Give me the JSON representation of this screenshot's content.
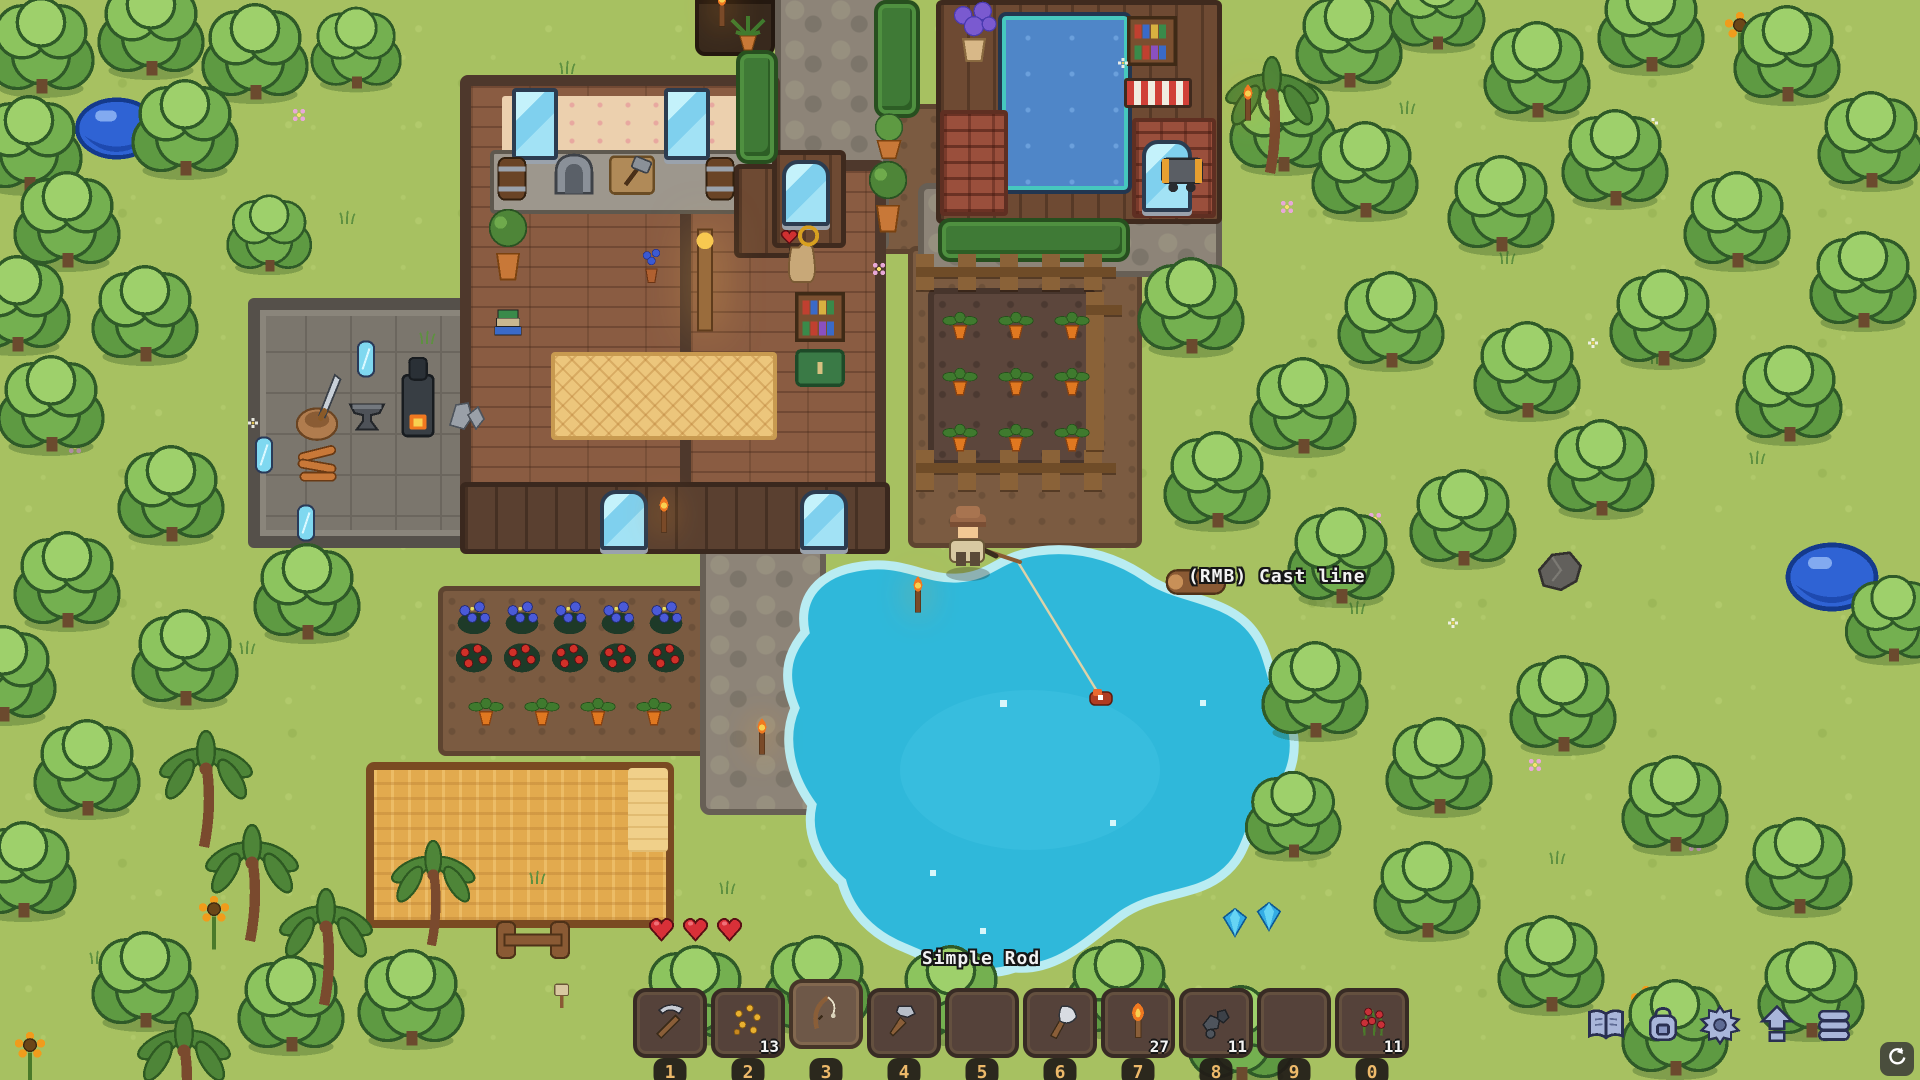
{
  "hud": {
    "selected_item_label": "Simple Rod",
    "action_hint": "(RMB) Cast line",
    "hotbar": {
      "slots": [
        {
          "key": "1",
          "icon": "pickaxe-icon",
          "count": null,
          "selected": false
        },
        {
          "key": "2",
          "icon": "seeds-icon",
          "count": "13",
          "selected": false
        },
        {
          "key": "3",
          "icon": "fishing-rod-icon",
          "count": null,
          "selected": true
        },
        {
          "key": "4",
          "icon": "hammer-icon",
          "count": null,
          "selected": false
        },
        {
          "key": "5",
          "icon": null,
          "count": null,
          "selected": false
        },
        {
          "key": "6",
          "icon": "axe-icon",
          "count": null,
          "selected": false
        },
        {
          "key": "7",
          "icon": "torch-icon",
          "count": "27",
          "selected": false
        },
        {
          "key": "8",
          "icon": "ore-icon",
          "count": "11",
          "selected": false
        },
        {
          "key": "9",
          "icon": null,
          "count": null,
          "selected": false
        },
        {
          "key": "0",
          "icon": "berries-icon",
          "count": "11",
          "selected": false
        }
      ]
    },
    "menu_buttons": [
      {
        "name": "journal-button",
        "icon": "book-icon"
      },
      {
        "name": "inventory-button",
        "icon": "backpack-icon"
      },
      {
        "name": "settings-button",
        "icon": "gear-icon"
      },
      {
        "name": "upgrades-button",
        "icon": "up-arrows-icon"
      },
      {
        "name": "storage-button",
        "icon": "barrel-icon"
      }
    ],
    "autosave_indicator": {
      "icon": "sync-icon"
    }
  },
  "colors": {
    "grass": "#a7c161",
    "water": "#2fb8da",
    "foam": "#b9ecf2",
    "hotbar_slot": "#55423a",
    "badge_text": "#edb96a",
    "menu_icon": "#a9b6da",
    "menu_icon_outline": "#2a3052",
    "heart": "#d83038",
    "gem": "#34ace4"
  },
  "scene": {
    "sprites": [
      {
        "t": "tree",
        "x": -18,
        "y": -6
      },
      {
        "t": "tree",
        "x": 92,
        "y": -24
      },
      {
        "t": "tree",
        "x": 196,
        "y": 0
      },
      {
        "t": "tree",
        "x": 306,
        "y": 4,
        "s": 0.85
      },
      {
        "t": "tree",
        "x": -30,
        "y": 92
      },
      {
        "t": "tree",
        "x": 126,
        "y": 76
      },
      {
        "t": "tree",
        "x": 8,
        "y": 168
      },
      {
        "t": "tree",
        "x": -42,
        "y": 252
      },
      {
        "t": "tree",
        "x": 86,
        "y": 262
      },
      {
        "t": "tree",
        "x": 222,
        "y": 192,
        "s": 0.8
      },
      {
        "t": "tree",
        "x": -8,
        "y": 352
      },
      {
        "t": "tree",
        "x": 112,
        "y": 442
      },
      {
        "t": "tree",
        "x": 8,
        "y": 528
      },
      {
        "t": "tree",
        "x": -56,
        "y": 622
      },
      {
        "t": "tree",
        "x": 126,
        "y": 606
      },
      {
        "t": "tree",
        "x": 248,
        "y": 540
      },
      {
        "t": "tree",
        "x": 28,
        "y": 716
      },
      {
        "t": "tree",
        "x": -36,
        "y": 818
      },
      {
        "t": "tree",
        "x": 86,
        "y": 928
      },
      {
        "t": "tree",
        "x": 232,
        "y": 952
      },
      {
        "t": "tree",
        "x": 352,
        "y": 946
      },
      {
        "t": "tree",
        "x": 636,
        "y": 942
      },
      {
        "t": "tree",
        "x": 758,
        "y": 932
      },
      {
        "t": "tree",
        "x": 892,
        "y": 942
      },
      {
        "t": "tree",
        "x": 1060,
        "y": 936
      },
      {
        "t": "tree",
        "x": 1182,
        "y": 982
      },
      {
        "t": "tree",
        "x": 1224,
        "y": 72
      },
      {
        "t": "tree",
        "x": 1290,
        "y": -12
      },
      {
        "t": "tree",
        "x": 1384,
        "y": -40,
        "s": 0.9
      },
      {
        "t": "tree",
        "x": 1478,
        "y": 18
      },
      {
        "t": "tree",
        "x": 1592,
        "y": -28
      },
      {
        "t": "tree",
        "x": 1728,
        "y": 2
      },
      {
        "t": "tree",
        "x": 1812,
        "y": 88
      },
      {
        "t": "tree",
        "x": 1306,
        "y": 118
      },
      {
        "t": "tree",
        "x": 1442,
        "y": 152
      },
      {
        "t": "tree",
        "x": 1556,
        "y": 106
      },
      {
        "t": "tree",
        "x": 1678,
        "y": 168
      },
      {
        "t": "tree",
        "x": 1804,
        "y": 228
      },
      {
        "t": "tree",
        "x": 1332,
        "y": 268
      },
      {
        "t": "tree",
        "x": 1468,
        "y": 318
      },
      {
        "t": "tree",
        "x": 1604,
        "y": 266
      },
      {
        "t": "tree",
        "x": 1730,
        "y": 342
      },
      {
        "t": "tree",
        "x": 1132,
        "y": 254
      },
      {
        "t": "tree",
        "x": 1244,
        "y": 354
      },
      {
        "t": "tree",
        "x": 1158,
        "y": 428
      },
      {
        "t": "tree",
        "x": 1282,
        "y": 504
      },
      {
        "t": "tree",
        "x": 1404,
        "y": 466
      },
      {
        "t": "tree",
        "x": 1542,
        "y": 416
      },
      {
        "t": "tree",
        "x": 1256,
        "y": 638
      },
      {
        "t": "tree",
        "x": 1380,
        "y": 714
      },
      {
        "t": "tree",
        "x": 1504,
        "y": 652
      },
      {
        "t": "tree",
        "x": 1368,
        "y": 838
      },
      {
        "t": "tree",
        "x": 1240,
        "y": 768,
        "s": 0.9
      },
      {
        "t": "tree",
        "x": 1616,
        "y": 752
      },
      {
        "t": "tree",
        "x": 1740,
        "y": 814
      },
      {
        "t": "tree",
        "x": 1492,
        "y": 912
      },
      {
        "t": "tree",
        "x": 1616,
        "y": 976
      },
      {
        "t": "tree",
        "x": 1752,
        "y": 938
      },
      {
        "t": "tree",
        "x": 1840,
        "y": 572,
        "s": 0.9
      },
      {
        "t": "palm",
        "x": 158,
        "y": 730
      },
      {
        "t": "palm",
        "x": 204,
        "y": 824
      },
      {
        "t": "palm",
        "x": 278,
        "y": 888
      },
      {
        "t": "palm",
        "x": 136,
        "y": 1012
      },
      {
        "t": "palm",
        "x": 390,
        "y": 840,
        "s": 0.9
      },
      {
        "t": "palm",
        "x": 1224,
        "y": 56
      },
      {
        "t": "slime",
        "x": 70,
        "y": 88,
        "s": 0.9
      },
      {
        "t": "slime",
        "x": 1780,
        "y": 532
      },
      {
        "t": "heart",
        "x": 646,
        "y": 914
      },
      {
        "t": "heart",
        "x": 680,
        "y": 914
      },
      {
        "t": "heart",
        "x": 714,
        "y": 914
      },
      {
        "t": "gem",
        "x": 1220,
        "y": 904
      },
      {
        "t": "gem",
        "x": 1254,
        "y": 898
      },
      {
        "t": "sunflower",
        "x": 1718,
        "y": 2
      },
      {
        "t": "sunflower",
        "x": 1624,
        "y": 976
      },
      {
        "t": "sunflower",
        "x": 192,
        "y": 886
      },
      {
        "t": "sunflower",
        "x": 8,
        "y": 1022
      },
      {
        "t": "rockbig",
        "x": 1534,
        "y": 544
      },
      {
        "t": "log",
        "x": 1158,
        "y": 566
      },
      {
        "t": "fencebit",
        "x": 490,
        "y": 918
      },
      {
        "t": "sign",
        "x": 546,
        "y": 980
      },
      {
        "t": "torchpost",
        "x": 902,
        "y": 572
      },
      {
        "t": "torchpost",
        "x": 746,
        "y": 714
      },
      {
        "t": "torchpost",
        "x": 706,
        "y": -14
      },
      {
        "t": "torchpost",
        "x": 1232,
        "y": 80
      },
      {
        "t": "torchpost",
        "x": 648,
        "y": 492
      },
      {
        "t": "pinkflower",
        "x": 288,
        "y": 104
      },
      {
        "t": "pinkflower",
        "x": 1414,
        "y": 286
      },
      {
        "t": "pinkflower",
        "x": 1364,
        "y": 508
      },
      {
        "t": "pinkflower",
        "x": 1684,
        "y": 834
      },
      {
        "t": "pinkflower",
        "x": 868,
        "y": 258
      },
      {
        "t": "pinkflower",
        "x": 64,
        "y": 436
      },
      {
        "t": "pinkflower",
        "x": 1524,
        "y": 754
      },
      {
        "t": "pinkflower",
        "x": 1276,
        "y": 196
      },
      {
        "t": "whiteflower",
        "x": 16,
        "y": 36
      },
      {
        "t": "whiteflower",
        "x": 1646,
        "y": 116
      },
      {
        "t": "whiteflower",
        "x": 1446,
        "y": 616
      },
      {
        "t": "whiteflower",
        "x": 246,
        "y": 416
      },
      {
        "t": "whiteflower",
        "x": 1116,
        "y": 56
      },
      {
        "t": "whiteflower",
        "x": 1586,
        "y": 336
      },
      {
        "t": "tuft",
        "x": 336,
        "y": 206
      },
      {
        "t": "tuft",
        "x": 416,
        "y": 326
      },
      {
        "t": "tuft",
        "x": 556,
        "y": 56
      },
      {
        "t": "tuft",
        "x": 1396,
        "y": 96
      },
      {
        "t": "tuft",
        "x": 1496,
        "y": 246
      },
      {
        "t": "tuft",
        "x": 1646,
        "y": 346
      },
      {
        "t": "tuft",
        "x": 1746,
        "y": 446
      },
      {
        "t": "tuft",
        "x": 1346,
        "y": 596
      },
      {
        "t": "tuft",
        "x": 1546,
        "y": 846
      },
      {
        "t": "tuft",
        "x": 1646,
        "y": 996
      },
      {
        "t": "tuft",
        "x": 236,
        "y": 636
      },
      {
        "t": "tuft",
        "x": 86,
        "y": 946
      },
      {
        "t": "tuft",
        "x": 526,
        "y": 866
      },
      {
        "t": "tuft",
        "x": 1046,
        "y": 1016
      },
      {
        "t": "tuft",
        "x": 716,
        "y": 876
      },
      {
        "t": "tuft",
        "x": 166,
        "y": 296
      },
      {
        "t": "carrot",
        "x": 940,
        "y": 306
      },
      {
        "t": "carrot",
        "x": 996,
        "y": 306
      },
      {
        "t": "carrot",
        "x": 1052,
        "y": 306
      },
      {
        "t": "carrot",
        "x": 940,
        "y": 362
      },
      {
        "t": "carrot",
        "x": 996,
        "y": 362
      },
      {
        "t": "carrot",
        "x": 1052,
        "y": 362
      },
      {
        "t": "carrot",
        "x": 940,
        "y": 418
      },
      {
        "t": "carrot",
        "x": 996,
        "y": 418
      },
      {
        "t": "carrot",
        "x": 1052,
        "y": 418
      },
      {
        "t": "carrot",
        "x": 466,
        "y": 692
      },
      {
        "t": "carrot",
        "x": 522,
        "y": 692
      },
      {
        "t": "carrot",
        "x": 578,
        "y": 692
      },
      {
        "t": "carrot",
        "x": 634,
        "y": 692
      },
      {
        "t": "blueflower",
        "x": 452,
        "y": 596
      },
      {
        "t": "blueflower",
        "x": 500,
        "y": 596
      },
      {
        "t": "blueflower",
        "x": 548,
        "y": 596
      },
      {
        "t": "blueflower",
        "x": 596,
        "y": 596
      },
      {
        "t": "blueflower",
        "x": 644,
        "y": 596
      },
      {
        "t": "tomato",
        "x": 452,
        "y": 636
      },
      {
        "t": "tomato",
        "x": 500,
        "y": 636
      },
      {
        "t": "tomato",
        "x": 548,
        "y": 636
      },
      {
        "t": "tomato",
        "x": 596,
        "y": 636
      },
      {
        "t": "tomato",
        "x": 644,
        "y": 636
      },
      {
        "t": "potbush",
        "x": 866,
        "y": 112
      },
      {
        "t": "pottree",
        "x": 866,
        "y": 158
      },
      {
        "t": "spiky",
        "x": 724,
        "y": 8
      },
      {
        "t": "sack",
        "x": 776,
        "y": 222
      },
      {
        "t": "minecart",
        "x": 1154,
        "y": 150
      },
      {
        "t": "mirror",
        "x": 352,
        "y": 338
      },
      {
        "t": "mirror",
        "x": 292,
        "y": 502
      },
      {
        "t": "mirror",
        "x": 250,
        "y": 434
      },
      {
        "t": "anvil",
        "x": 342,
        "y": 390
      },
      {
        "t": "furnace",
        "x": 392,
        "y": 352
      },
      {
        "t": "stones",
        "x": 442,
        "y": 388
      },
      {
        "t": "firewood",
        "x": 292,
        "y": 438
      },
      {
        "t": "stumpsword",
        "x": 290,
        "y": 366
      },
      {
        "t": "books",
        "x": 488,
        "y": 296
      },
      {
        "t": "bookshelf",
        "x": 1124,
        "y": 12
      },
      {
        "t": "bookshelf",
        "x": 792,
        "y": 288
      },
      {
        "t": "cabinet",
        "x": 792,
        "y": 346
      },
      {
        "t": "flowerpot",
        "x": 638,
        "y": 246
      },
      {
        "t": "pottree",
        "x": 486,
        "y": 206
      },
      {
        "t": "lamp",
        "x": 688,
        "y": 224
      },
      {
        "t": "purpleplant",
        "x": 948,
        "y": 0
      },
      {
        "t": "keg",
        "x": 492,
        "y": 152
      },
      {
        "t": "keg",
        "x": 700,
        "y": 152
      },
      {
        "t": "grinder",
        "x": 546,
        "y": 146
      },
      {
        "t": "hammertable",
        "x": 606,
        "y": 148
      }
    ]
  }
}
